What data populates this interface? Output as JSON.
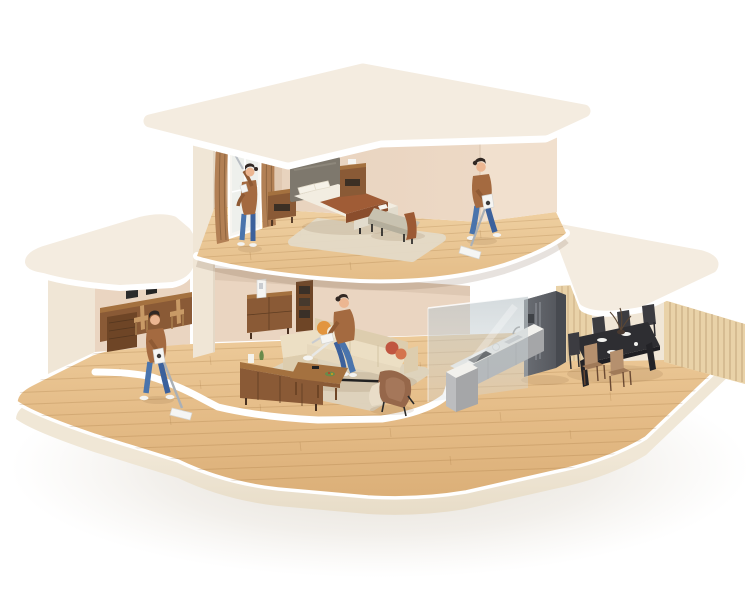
{
  "scene": {
    "title": "Two-story home cutaway with people cleaning",
    "description": "Isometric 3D-style cutaway illustration of a cream two-story dollhouse standing on a large rounded wood-floor base. Four people in brown sweaters and blue jeans clean the home: one wipes the bedroom window with an extendable cleaner, one vacuums the bedroom floor with a cordless stick vacuum, one sits on the living-room sofa using a handheld vacuum, and one vacuums the ground-floor hallway.",
    "people_total": 4,
    "floors": [
      {
        "level": "upper",
        "rooms": [
          {
            "name": "bedroom",
            "furniture": [
              "double bed with grey headboard and brown throw blanket",
              "walnut nightstand left",
              "walnut nightstand right with white clock",
              "upholstered bench with brown towel and open book",
              "beige area rug",
              "window with brown curtains"
            ],
            "people": [
              "person wiping the window with an extendable window cleaner",
              "person vacuuming the wood floor with a cordless stick vacuum"
            ]
          }
        ]
      },
      {
        "level": "ground",
        "rooms": [
          {
            "name": "study",
            "furniture": [
              "wall-length walnut desk",
              "two laptops",
              "two wooden chairs",
              "walnut drawer cabinet",
              "floating wall shelf"
            ]
          },
          {
            "name": "living-room",
            "furniture": [
              "cream L-shaped sofa with orange and rust pillows",
              "walnut media console with plant",
              "walnut coffee table with remote and snack plate",
              "brown armchair with cream throw",
              "beige area rug",
              "walnut sideboard",
              "walnut shelf unit",
              "white vacuum charging dock"
            ],
            "people": [
              "person sitting on the sofa using a white handheld vacuum",
              "person vacuuming the wood floor with a cordless stick vacuum"
            ]
          },
          {
            "name": "kitchen",
            "furniture": [
              "grey L-shaped counter with white top, black cooktop, sink, faucet and kettle",
              "grey double-door refrigerator",
              "frosted glass partition"
            ]
          },
          {
            "name": "dining-room",
            "furniture": [
              "black dining table with plates, cups and branch vase",
              "three black chairs",
              "two tan chairs",
              "vertical wood-slat wall"
            ]
          }
        ]
      }
    ]
  },
  "colors": {
    "background": "#ffffff",
    "ground_shadow": "rgba(186,172,150,0.45)",
    "roof_top": "#f4ece0",
    "roof_rim": "#ffffff",
    "wall_cream": "#f0e6d6",
    "wall_pink": "#ead5c1",
    "wall_pink_dark": "#e0c8b1",
    "wall_lit": "#f1e0ce",
    "wood_light": "#eecd9d",
    "wood_dark": "#d9ac74",
    "plank_line": "rgba(150,104,52,0.22)",
    "walnut": "#8a5a36",
    "walnut_dark": "#6e4526",
    "walnut_light": "#a4713f",
    "sofa_cream": "#ecdfc4",
    "sofa_dark": "#ddcdae",
    "rug": "#ded4bf",
    "rug_bedroom": "#e4dbc8",
    "headboard": "#7e786d",
    "bedding": "#f2ede1",
    "blanket": "#a05c36",
    "blanket_dark": "#8a4d2c",
    "bench": "#c8c2b0",
    "curtain": "#b28055",
    "curtain_dark": "#8f6540",
    "glass": "rgba(180,192,198,0.5)",
    "counter_top": "#f2f1ed",
    "counter_gray": "#a5a6a8",
    "counter_light": "#bcbdbf",
    "fridge": "#63666c",
    "fridge_dark": "#474a50",
    "table_black": "#2e2e32",
    "chair_black": "#3c3c41",
    "chair_tan": "#b5906e",
    "chair_tan_dark": "#a07a58",
    "panel_wood": "#e9d2a8",
    "slat_line": "rgba(122,86,44,0.28)",
    "skin": "#ecb691",
    "hair": "#322823",
    "sweater": "#a46a40",
    "sweater_dark": "#8f5a34",
    "jeans": "#4a74ac",
    "jeans_dark": "#3c619c",
    "shoe": "#f3f3f1",
    "vacuum_white": "#f5f5f3",
    "vacuum_gray": "#aab0b6",
    "pillow_orange": "#e2953f",
    "pillow_red": "#c05540",
    "pillow_rust": "#d4734d",
    "armchair_brown": "#96674a",
    "throw_cream": "#e9ddc8",
    "soft_shadow": "rgba(130,95,60,0.14)"
  }
}
